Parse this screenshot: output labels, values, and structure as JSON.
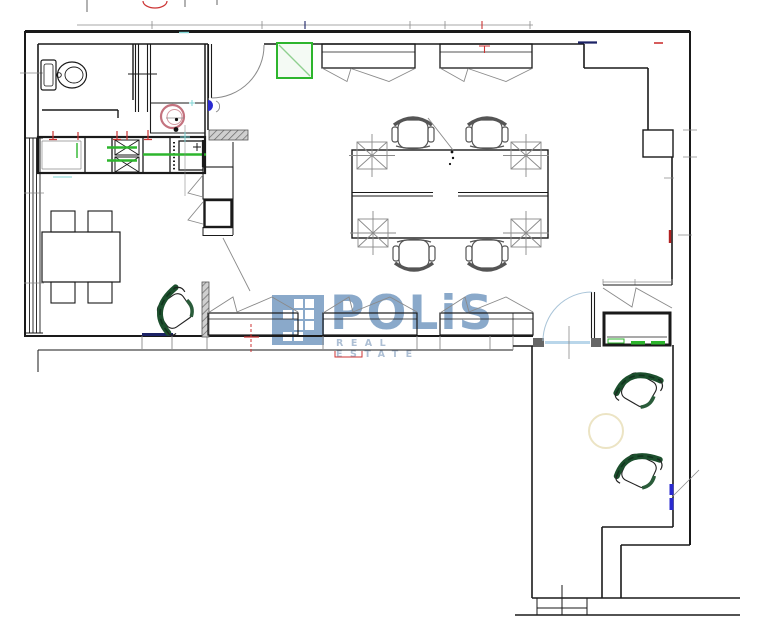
{
  "watermark": {
    "title": "POLiS",
    "subtitle": "REAL ESTATE"
  },
  "colors": {
    "wall": "#1a1a1a",
    "thin": "#8a8a8a",
    "red": "#cc3333",
    "green": "#2db52d",
    "dark_green": "#1c4f2d",
    "pink": "#c4737f",
    "navy": "#1c2366",
    "cyan": "#7fd4d4",
    "blue": "#2a2ad0",
    "yellow": "#ece4c4",
    "door_blue": "#b9d6ea",
    "wm": "#84a5c8",
    "wm_light": "#a9bcd2"
  },
  "icons": {
    "toilet-icon": "toilet plan symbol",
    "washbasin-icon": "round basin with drain dot",
    "sink-icon": "double crossed-box sink",
    "fridge-icon": "appliance box with plus",
    "ac-unit-icon": "green square with diagonal",
    "radiator-icon": "zigzag under window",
    "office-chair-icon": "swivel desk chair",
    "armchair-icon": "dark green armchair",
    "floor-box-icon": "crossed square with axis lines",
    "door-icon": "quarter-circle door swing",
    "stairs-icon": "entry steps",
    "watermark-logo-icon": "blue pixel-grid square"
  }
}
